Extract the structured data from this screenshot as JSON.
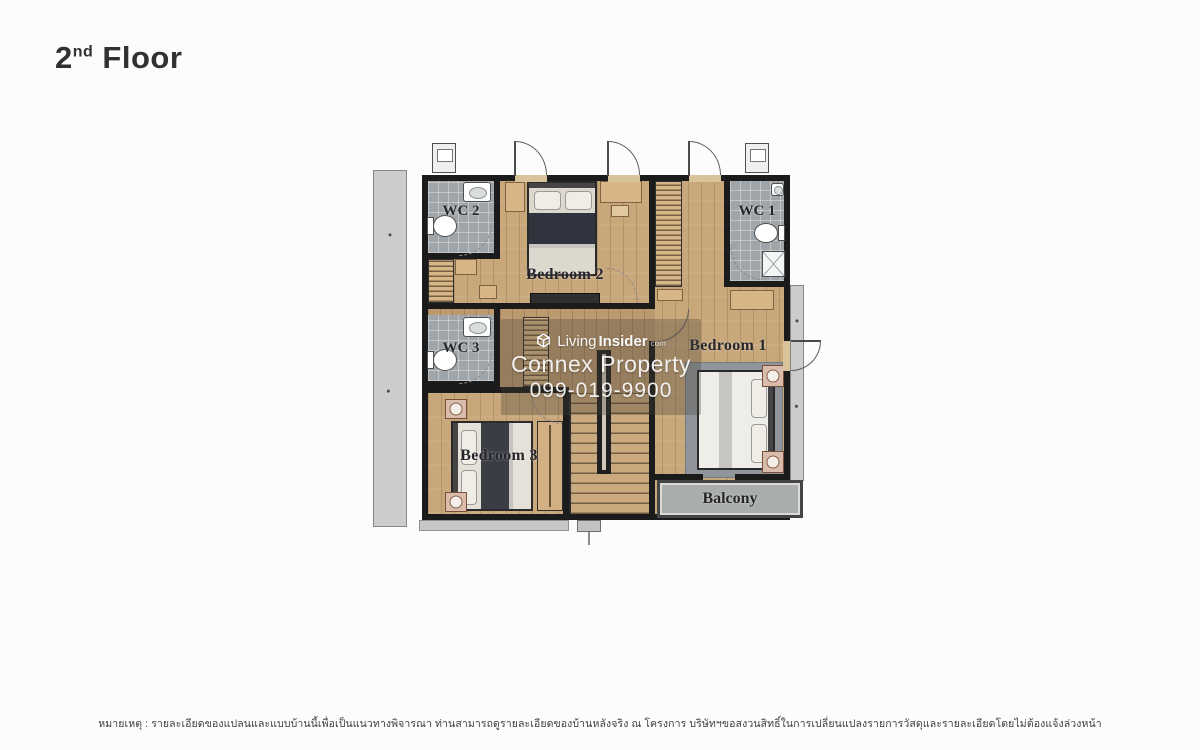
{
  "title": {
    "prefix": "2",
    "ordinal": "nd",
    "word": "Floor"
  },
  "plan": {
    "rooms": {
      "wc2": "WC 2",
      "wc1": "WC 1",
      "wc3": "WC 3",
      "bedroom2": "Bedroom 2",
      "bedroom1": "Bedroom 1",
      "bedroom3": "Bedroom 3",
      "balcony": "Balcony"
    },
    "colors": {
      "wall": "#1b1b1b",
      "wood_floor": "#c8a77b",
      "corridor_floor": "#bb9a70",
      "wc_tile": "#9fa5a8",
      "balcony": "#a9aeab",
      "roof_strip": "#cbcdca",
      "rug": "#90959b",
      "label_text": "#26262a"
    }
  },
  "watermark": {
    "living": "Living",
    "insider": "Insider",
    "tld": "com",
    "company": "Connex Property",
    "phone": "099-019-9900"
  },
  "footer": {
    "note": "หมายเหตุ : รายละเอียดของแปลนและแบบบ้านนี้เพื่อเป็นแนวทางพิจารณา ท่านสามารถดูรายละเอียดของบ้านหลังจริง ณ โครงการ บริษัทฯขอสงวนสิทธิ์ในการเปลี่ยนแปลงรายการวัสดุและรายละเอียดโดยไม่ต้องแจ้งล่วงหน้า"
  }
}
